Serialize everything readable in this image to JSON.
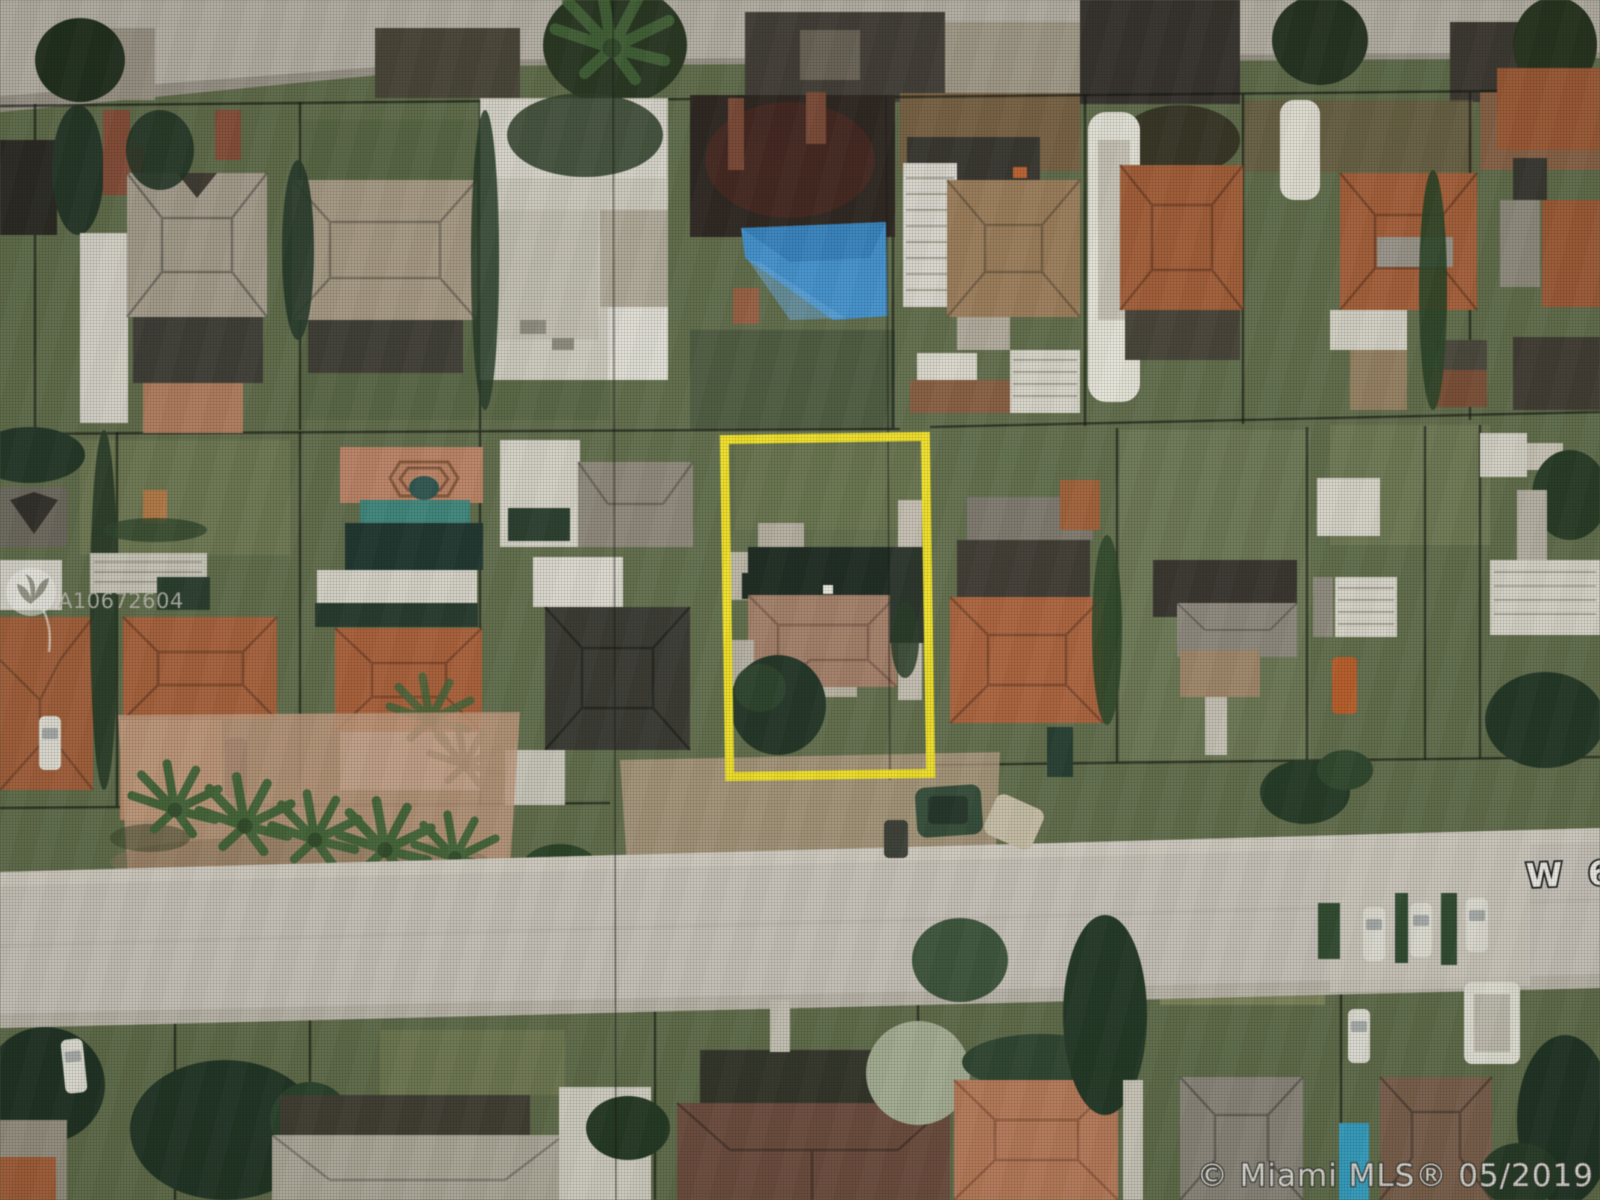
{
  "canvas": {
    "width": 1600,
    "height": 1200
  },
  "overlays": {
    "listing_id": "A10672604",
    "street_label": "W 6",
    "copyright": "© Miami MLS® 05/2019"
  },
  "icons": {
    "watermark_logo": "miami-mls-bird-circle-logo"
  },
  "colors": {
    "highlight_yellow": "#f2e012",
    "tarp_blue": "#3a93d8",
    "pool_teal": "#35857b",
    "pool_cyan": "#2ba3c9",
    "road": "#c9c4ba",
    "grass": "#5d6b45",
    "terracotta_roof": "#ad5e33",
    "charcoal_roof": "#34342c",
    "gray_roof": "#a79d8c",
    "subject_brown_roof": "#a47b63",
    "paver_salmon": "#c08a68",
    "watermark_gray": "#b8b6ac",
    "label_white": "#f2f0ea"
  }
}
